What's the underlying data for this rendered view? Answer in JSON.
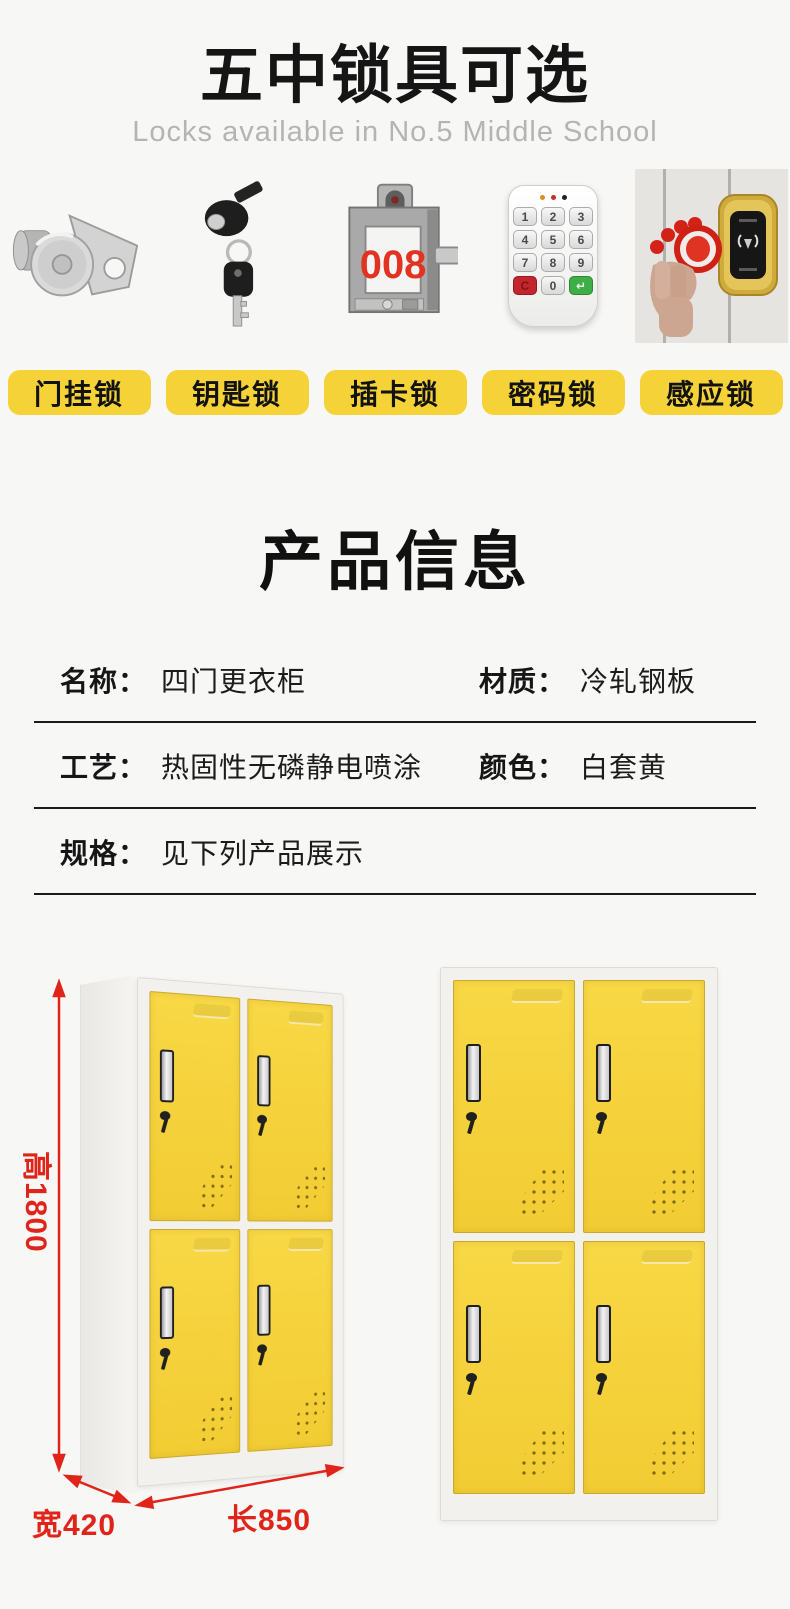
{
  "page": {
    "background": "#f7f7f5"
  },
  "hero": {
    "title": "五中锁具可选",
    "subtitle": "Locks available in No.5 Middle School"
  },
  "locks": {
    "label_background": "#f5d338",
    "items": [
      {
        "label": "门挂锁",
        "image": "hasp-lock-photo"
      },
      {
        "label": "钥匙锁",
        "image": "key-lock-photo"
      },
      {
        "label": "插卡锁",
        "image": "card-lock-photo",
        "display": "008"
      },
      {
        "label": "密码锁",
        "image": "keypad-lock-photo",
        "keys": [
          "1",
          "2",
          "3",
          "4",
          "5",
          "6",
          "7",
          "8",
          "9",
          "C",
          "0",
          "↵"
        ]
      },
      {
        "label": "感应锁",
        "image": "induction-lock-photo"
      }
    ]
  },
  "product_info": {
    "title": "产品信息",
    "rows": [
      {
        "cells": [
          {
            "label": "名称：",
            "value": "四门更衣柜"
          },
          {
            "label": "材质：",
            "value": "冷轧钢板"
          }
        ]
      },
      {
        "cells": [
          {
            "label": "工艺：",
            "value": "热固性无磷静电喷涂"
          },
          {
            "label": "颜色：",
            "value": "白套黄"
          }
        ]
      },
      {
        "cells": [
          {
            "label": "规格：",
            "value": "见下列产品展示"
          }
        ]
      }
    ]
  },
  "showcase": {
    "dimensions": {
      "height": "高1800",
      "width": "宽420",
      "length": "长850"
    },
    "colors": {
      "dimension_red": "#e02419",
      "door_yellow": "#f5d23a",
      "cabinet_white": "#f3f1ee"
    }
  }
}
